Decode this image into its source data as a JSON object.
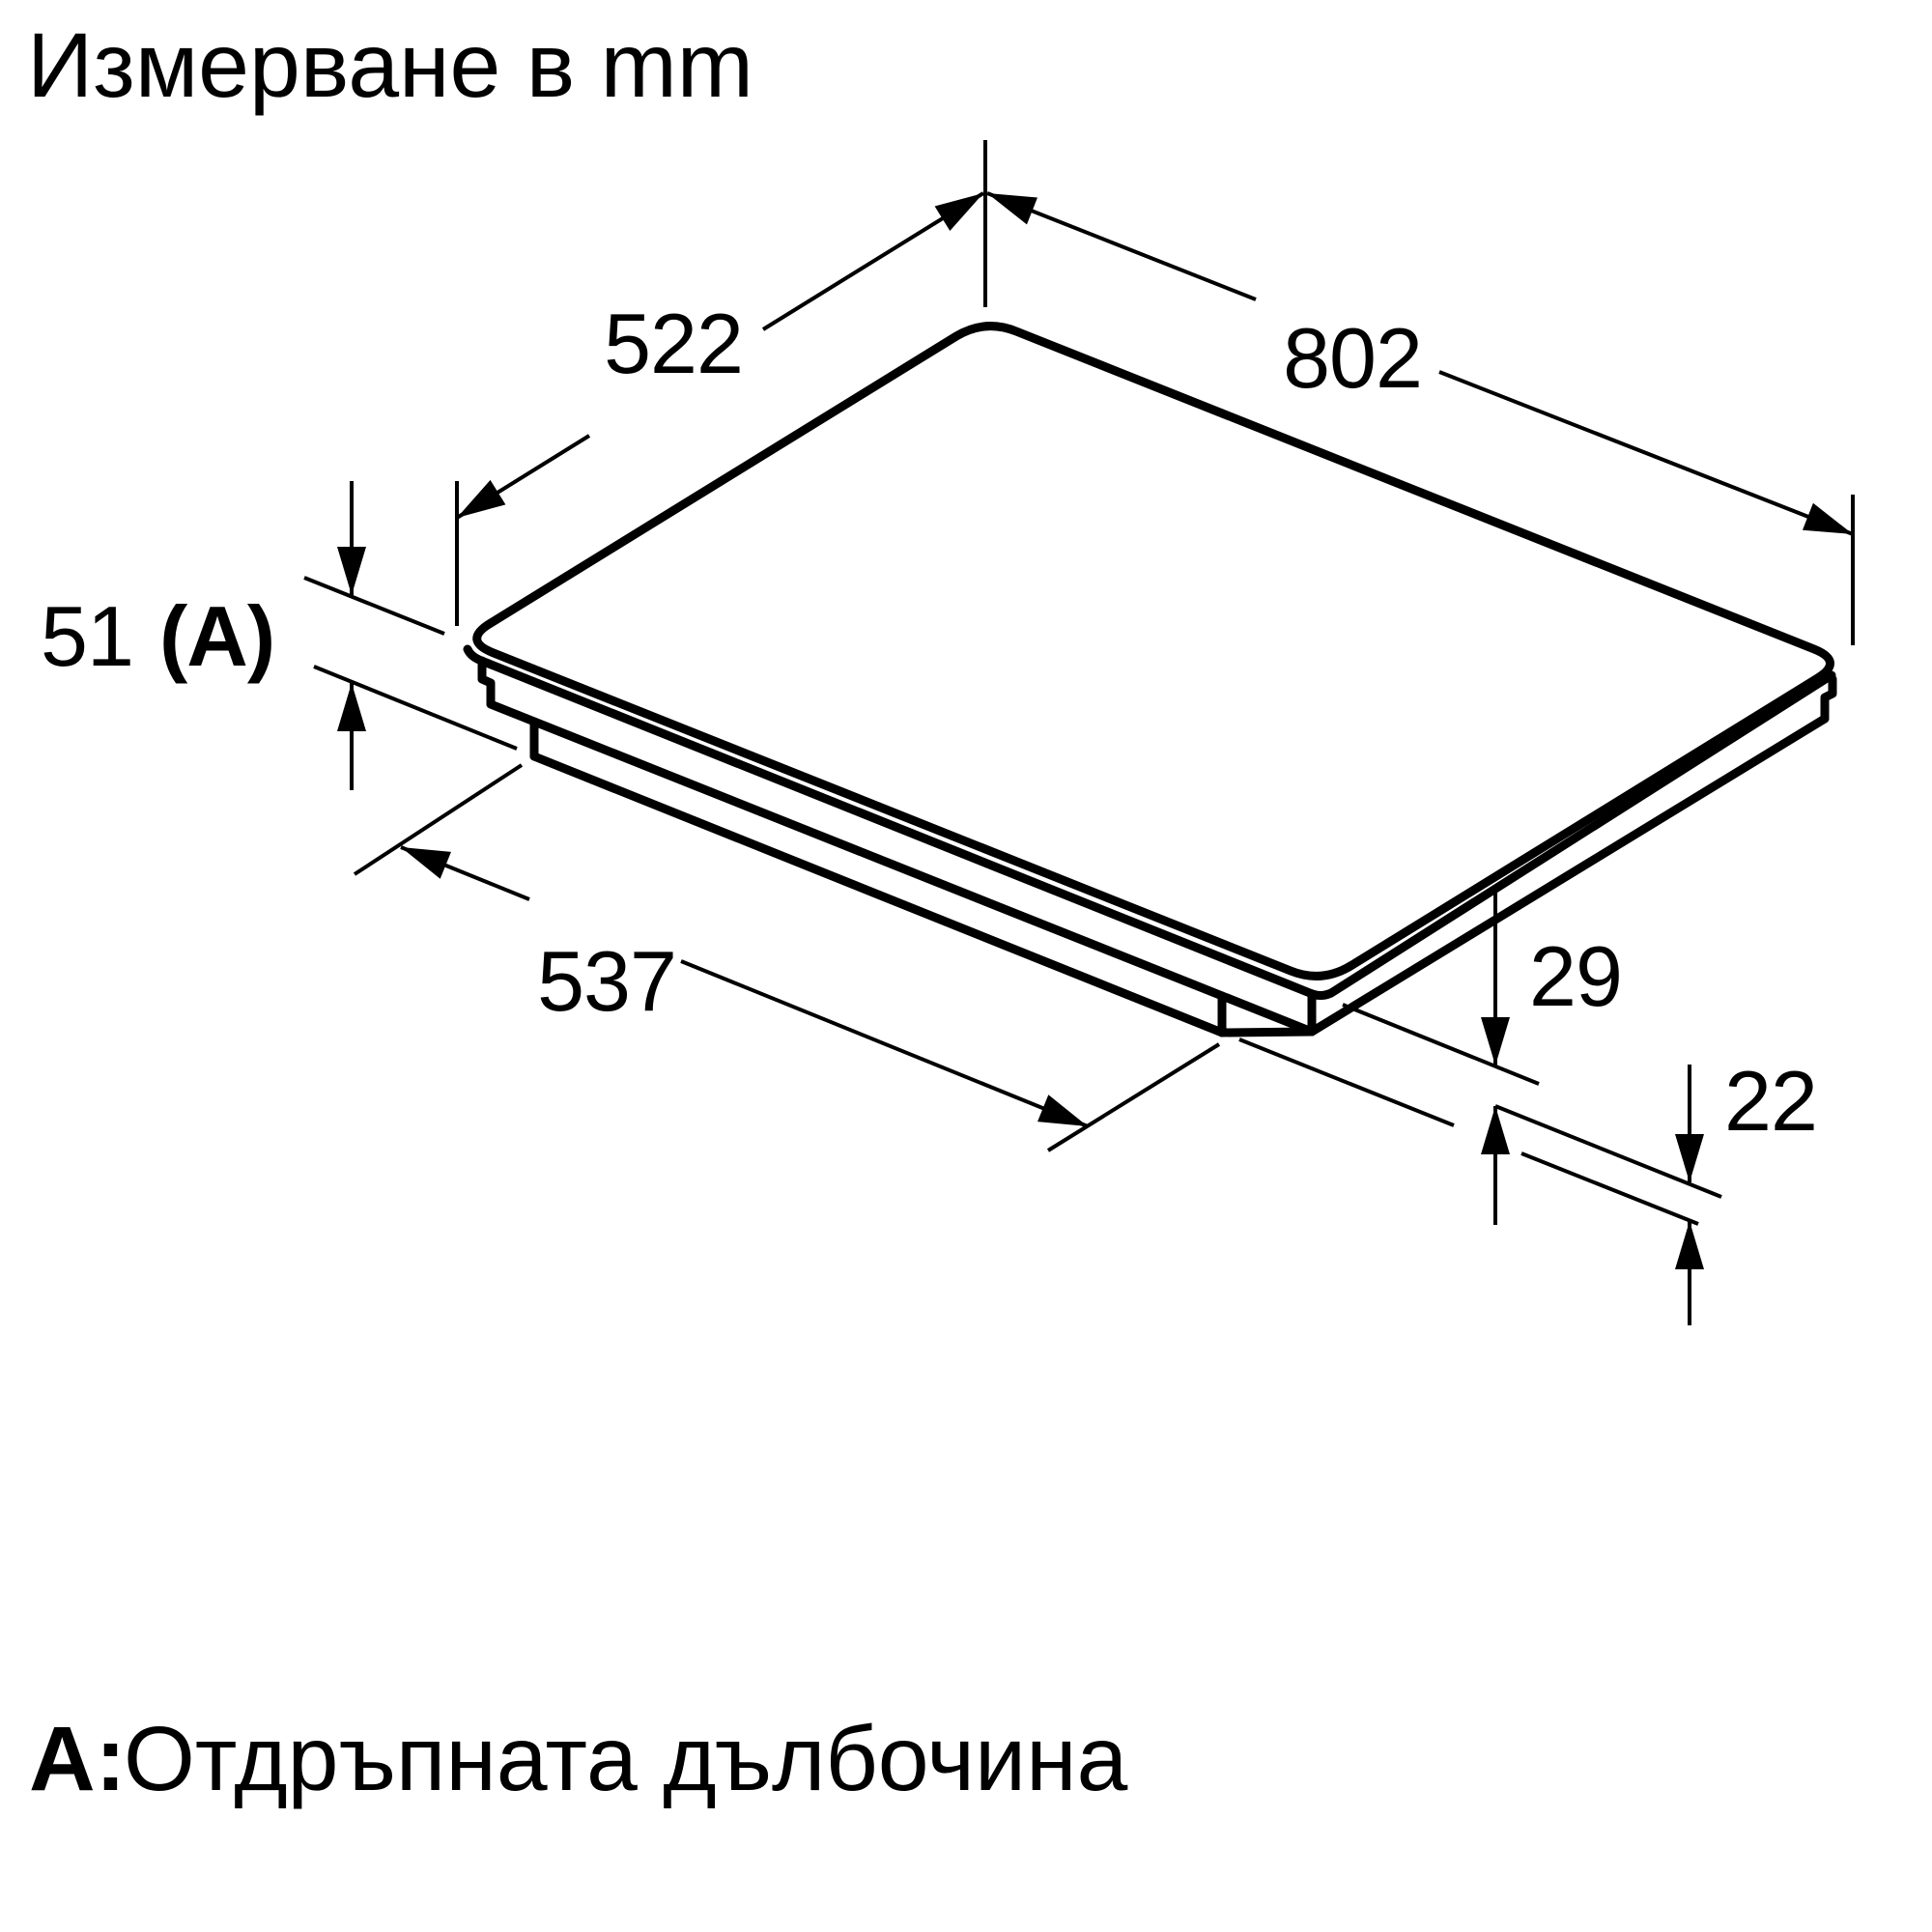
{
  "title": "Измерване в mm",
  "footnote": {
    "prefix": "A:",
    "text": "Отдръпната дълбочина"
  },
  "dimensions": {
    "top_depth": "522",
    "top_width": "802",
    "recess_height": "51",
    "recess_ref": "(A)",
    "base_width": "537",
    "upper_step_height": "29",
    "lower_step_height": "22"
  },
  "colors": {
    "ink": "#000000",
    "background": "#ffffff"
  }
}
